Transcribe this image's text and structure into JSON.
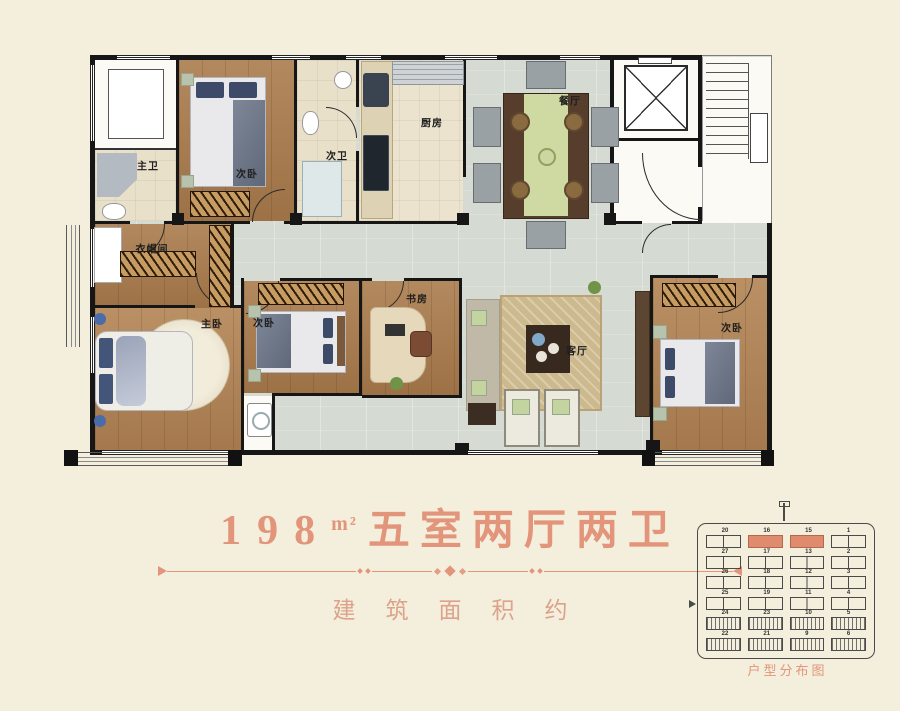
{
  "title": {
    "area_value": "198",
    "area_unit": "m²",
    "layout_text": "五室两厅两卫",
    "subtitle": "建筑面积约"
  },
  "floorplan": {
    "rooms": [
      {
        "id": "master-bath",
        "label": "主卫"
      },
      {
        "id": "bedroom-top",
        "label": "次卧"
      },
      {
        "id": "second-bath",
        "label": "次卫"
      },
      {
        "id": "kitchen",
        "label": "厨房"
      },
      {
        "id": "dining",
        "label": "餐厅"
      },
      {
        "id": "cloakroom",
        "label": "衣帽间"
      },
      {
        "id": "master-bedroom",
        "label": "主卧"
      },
      {
        "id": "bedroom-middle",
        "label": "次卧"
      },
      {
        "id": "study",
        "label": "书房"
      },
      {
        "id": "living",
        "label": "客厅"
      },
      {
        "id": "bedroom-right",
        "label": "次卧"
      }
    ]
  },
  "minimap": {
    "caption": "户型分布图",
    "rows": [
      [
        "20",
        "16",
        "15",
        "1"
      ],
      [
        "27",
        "17",
        "13",
        "2"
      ],
      [
        "26",
        "18",
        "12",
        "3"
      ],
      [
        "25",
        "19",
        "11",
        "4"
      ],
      [
        "24",
        "23",
        "10",
        "5"
      ],
      [
        "22",
        "21",
        "9",
        "6"
      ]
    ],
    "highlights": [
      [
        0,
        1
      ],
      [
        0,
        2
      ]
    ]
  },
  "colors": {
    "accent": "#e2957b",
    "highlight": "#e08a6e"
  }
}
